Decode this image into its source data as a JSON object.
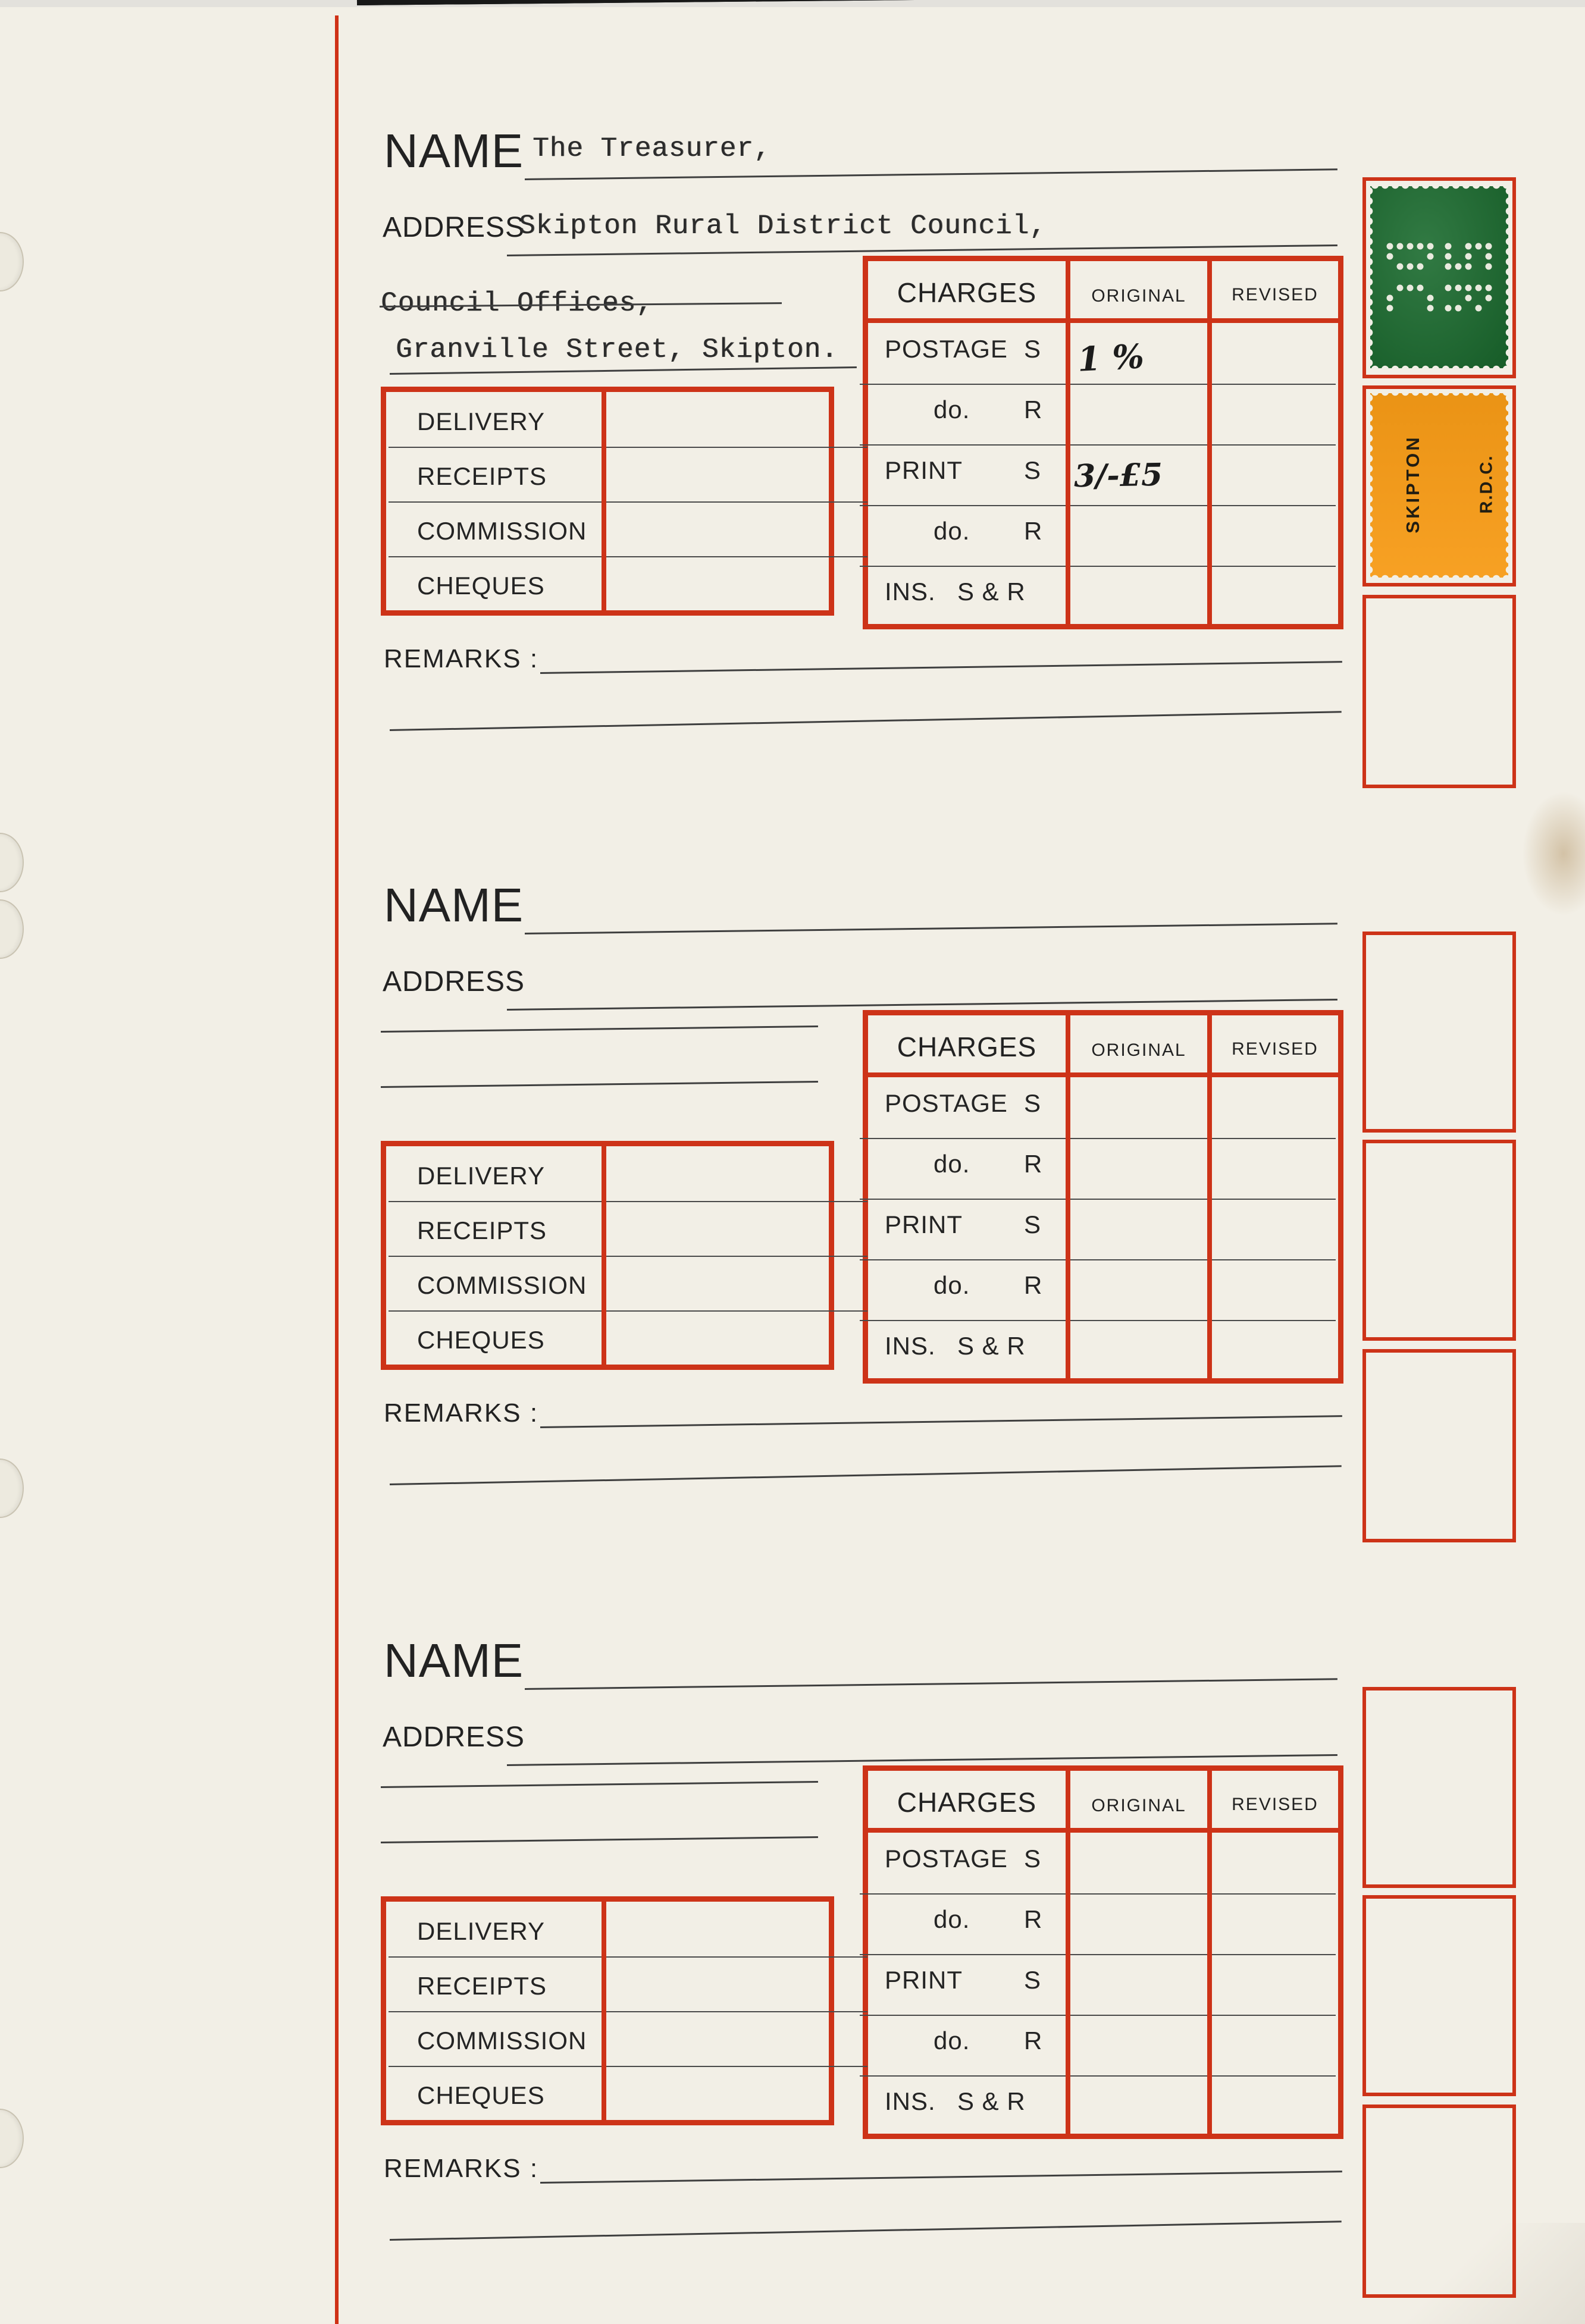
{
  "colors": {
    "paper": "#f2efe6",
    "accent_red": "#cd3318",
    "stamp_green": "#1a6b2e",
    "stamp_orange": "#f79b16",
    "ink": "#242424"
  },
  "page": {
    "labels": {
      "name": "NAME",
      "address": "ADDRESS",
      "remarks": "REMARKS :"
    },
    "charges": {
      "title": "CHARGES",
      "col_original": "ORIGINAL",
      "col_revised": "REVISED",
      "rows": [
        {
          "label": "POSTAGE",
          "qual": "S"
        },
        {
          "label": "do.",
          "qual": "R"
        },
        {
          "label": "PRINT",
          "qual": "S"
        },
        {
          "label": "do.",
          "qual": "R"
        },
        {
          "label": "INS.",
          "qual": "S & R"
        }
      ]
    },
    "delivery": {
      "rows": [
        "DELIVERY",
        "RECEIPTS",
        "COMMISSION",
        "CHEQUES"
      ]
    }
  },
  "sections": [
    {
      "name_value": "The Treasurer,",
      "address_value": "Skipton Rural District Council,",
      "address_line2": "Council Offices,",
      "address_line3": "Granville Street, Skipton.",
      "charges_entries": {
        "postage_s_original": "1 %",
        "print_s_original": "3/-£5"
      },
      "stamps": {
        "green": {
          "perfin_letters": [
            "S",
            "R",
            "D",
            "C"
          ]
        },
        "orange": {
          "text_left": "SKIPTON",
          "text_right": "R.D.C."
        }
      }
    },
    {
      "name_value": "",
      "address_value": ""
    },
    {
      "name_value": "",
      "address_value": ""
    }
  ]
}
